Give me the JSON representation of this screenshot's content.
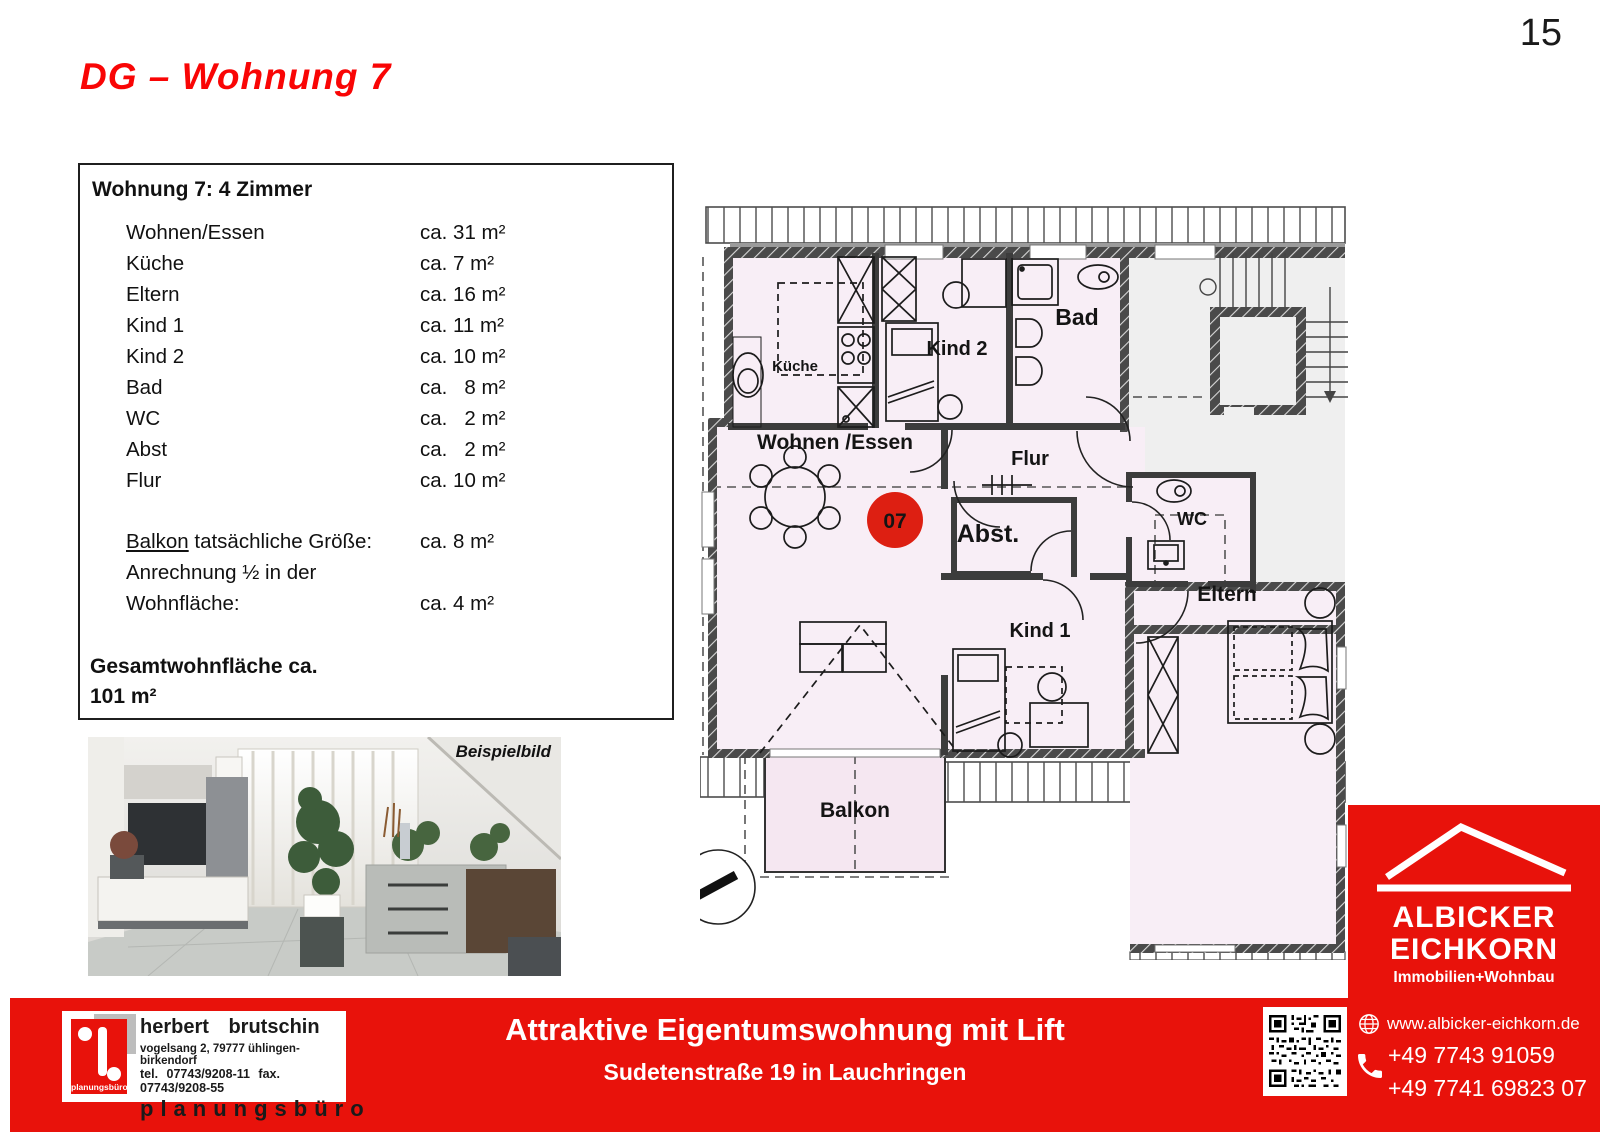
{
  "page": {
    "number": "15"
  },
  "title": "DG – Wohnung 7",
  "info_box": {
    "heading": "Wohnung 7: 4 Zimmer",
    "rooms": [
      {
        "label": "Wohnen/Essen",
        "value": "ca. 31 m²"
      },
      {
        "label": "Küche",
        "value": "ca. 7 m²"
      },
      {
        "label": "Eltern",
        "value": "ca. 16 m²"
      },
      {
        "label": "Kind 1",
        "value": "ca. 11 m²"
      },
      {
        "label": "Kind 2",
        "value": "ca. 10 m²"
      },
      {
        "label": "Bad",
        "value": "ca.   8 m²"
      },
      {
        "label": "WC",
        "value": "ca.   2 m²"
      },
      {
        "label": "Abst",
        "value": "ca.   2 m²"
      },
      {
        "label": "Flur",
        "value": "ca. 10 m²"
      }
    ],
    "balkon": {
      "label_underlined": "Balkon",
      "label_rest": " tatsächliche Größe:",
      "value": "ca. 8 m²",
      "line2": "Anrechnung ½ in der",
      "line3_label": "Wohnfläche:",
      "line3_value": "ca. 4 m²"
    },
    "total_line1": "Gesamtwohnfläche ca.",
    "total_line2": "101 m²"
  },
  "photo": {
    "caption": "Beispielbild"
  },
  "plan": {
    "unit_badge": "07",
    "rooms": {
      "kueche": "Küche",
      "kind2": "Kind 2",
      "bad": "Bad",
      "wohnen": "Wohnen /Essen",
      "flur": "Flur",
      "abst": "Abst.",
      "wc": "WC",
      "kind1": "Kind 1",
      "eltern": "Eltern",
      "balkon": "Balkon"
    }
  },
  "banner": {
    "headline": "Attraktive Eigentumswohnung mit Lift",
    "subline": "Sudetenstraße 19 in Lauchringen"
  },
  "brutschin": {
    "name": "herbert brutschin",
    "address": "vogelsang 2, 79777 ühlingen-birkendorf",
    "phone": "tel. 07743/9208-11 fax. 07743/9208-55",
    "word": "planungsbüro",
    "icon_caption": "planungsbüro"
  },
  "albicker": {
    "line1": "ALBICKER",
    "line2": "EICHKORN",
    "tagline": "Immobilien+Wohnbau",
    "website": "www.albicker-eichkorn.de",
    "phone1": "+49 7743 91059",
    "phone2": "+49 7741 69823 07"
  },
  "colors": {
    "brand_red": "#e8120b",
    "title_red": "#f90505",
    "plan_pink": "#f8eef6",
    "balcony_pink": "#f5e7f1",
    "stair_gray": "#efefef",
    "wall_dark": "#4a4a4a"
  }
}
